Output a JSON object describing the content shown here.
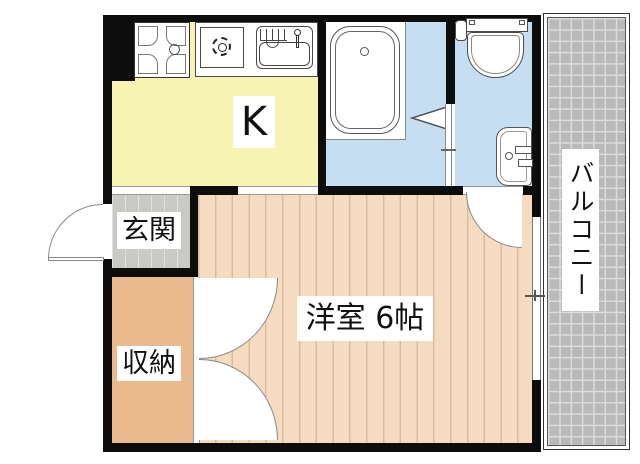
{
  "floorplan": {
    "type": "japanese-apartment-floor-plan",
    "rooms": {
      "kitchen": {
        "label": "K",
        "color": "#f7f4b3"
      },
      "bath": {
        "label": "",
        "color": "#c5def2"
      },
      "washroom": {
        "label": "",
        "color": "#c5def2"
      },
      "entrance": {
        "label": "玄関",
        "color": "#c9c9c6"
      },
      "storage": {
        "label": "収納",
        "color": "#eaba8c"
      },
      "western_room": {
        "label": "洋室 6帖",
        "color": "#f5dcc1"
      },
      "balcony": {
        "label": "バルコニー",
        "color": "#b9b9b9"
      }
    },
    "fixtures": [
      "stove",
      "gas-burner",
      "kitchen-sink",
      "bathtub",
      "toilet",
      "washbasin"
    ],
    "doors": [
      "entrance-swing-door",
      "closet-double-doors",
      "washroom-swing-door",
      "bath-folding-door"
    ],
    "colors": {
      "wall": "#0d0d0d",
      "floor_stripe_line": "#d9bc9e",
      "balcony_grid_line": "#dcdcdc",
      "label_background": "#ffffff",
      "text": "#111111"
    }
  }
}
